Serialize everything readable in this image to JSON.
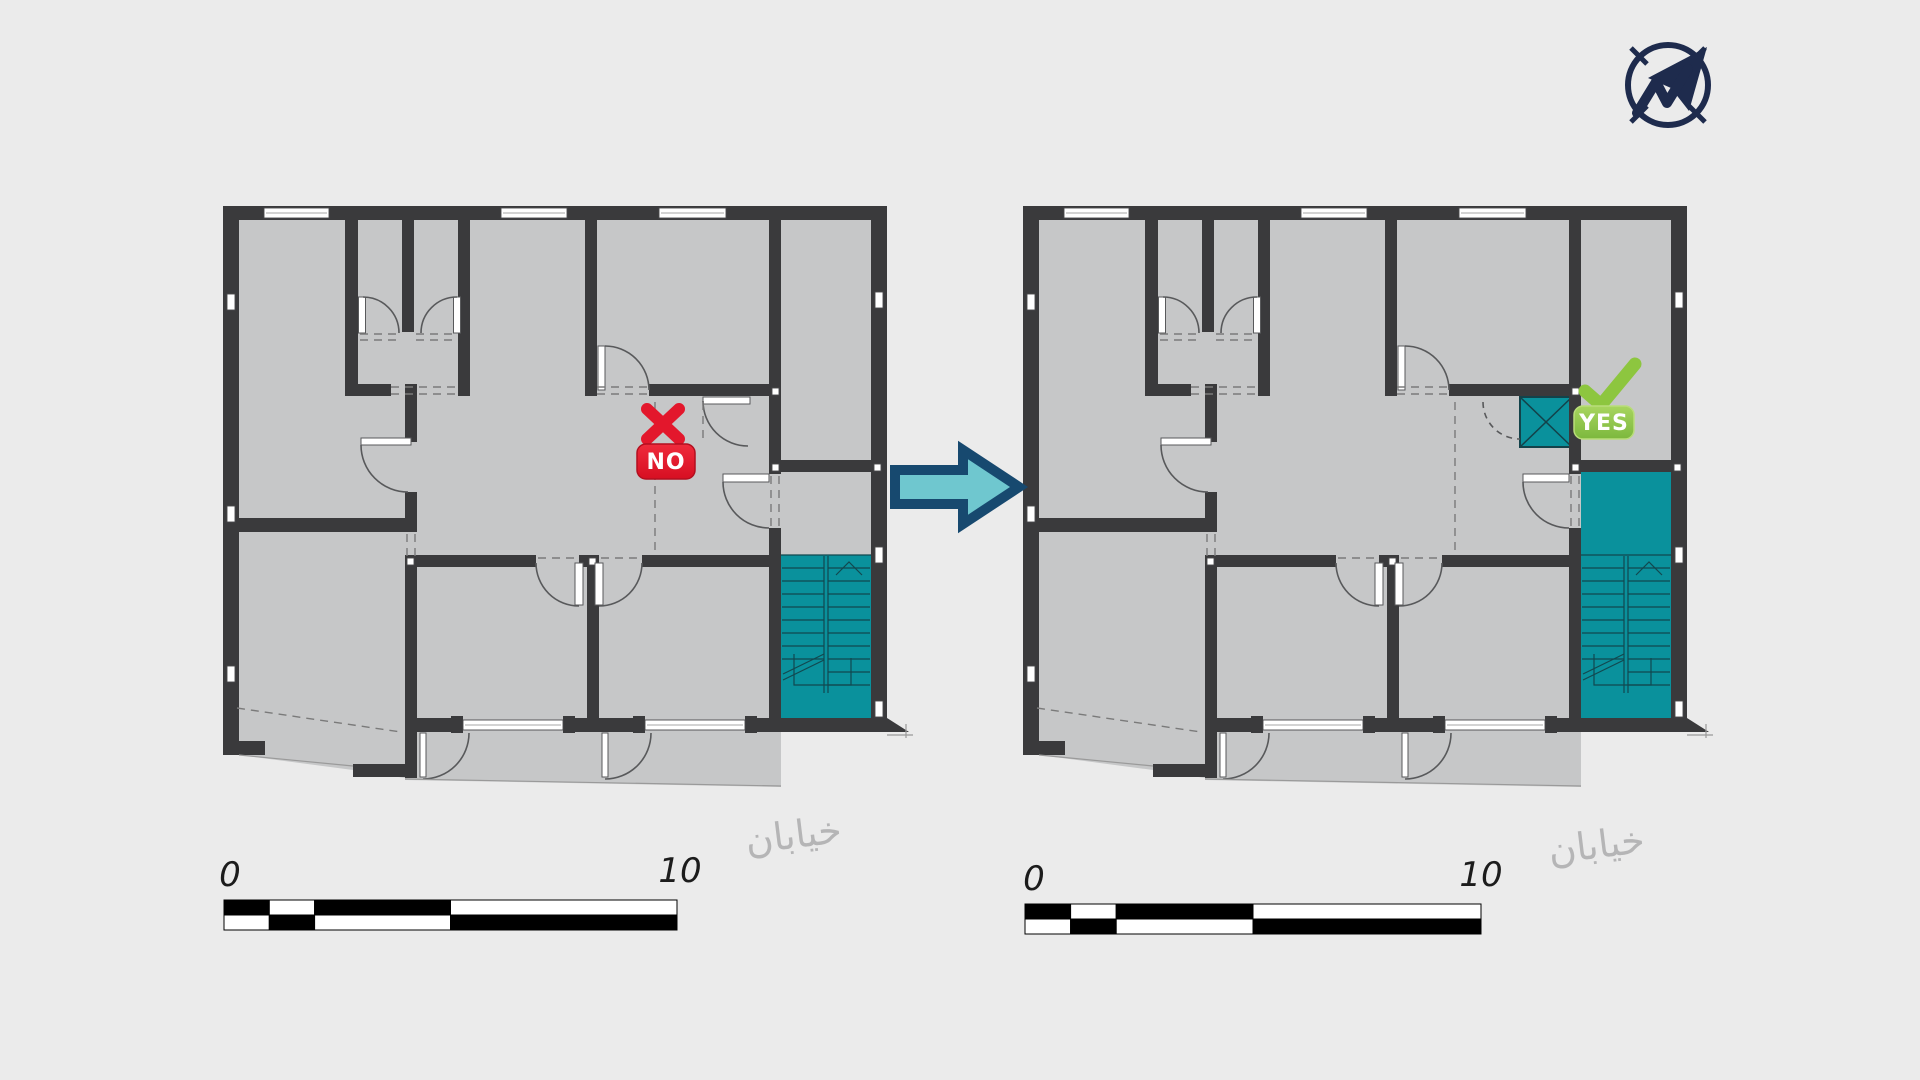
{
  "figure": {
    "type": "architectural-floor-plan-comparison",
    "description": "Two identical apartment floor plans; left option rejected, right option (with elevator added beside stair core) accepted"
  },
  "markers": {
    "no": "NO",
    "yes": "YES"
  },
  "scale_bar": {
    "start_label": "0",
    "end_label": "10",
    "segments": [
      0.1,
      0.1,
      0.3,
      0.5
    ]
  },
  "street_label": "خیابان",
  "icons": {
    "compass": "north-arrow-compass",
    "arrow": "transform-right-arrow",
    "x_mark": "rejected-cross",
    "check_mark": "accepted-check",
    "stairs": "stair-core",
    "elevator": "elevator-shaft"
  },
  "colors": {
    "background": "#ebebeb",
    "wall": "#3a3a3c",
    "floor": "#c6c7c8",
    "core_teal": "#0a919c",
    "no_red": "#e3172c",
    "yes_green": "#8dc63f",
    "compass_navy": "#1e2b4d",
    "arrow_fill": "#6fc7cf",
    "arrow_stroke": "#17496f"
  }
}
